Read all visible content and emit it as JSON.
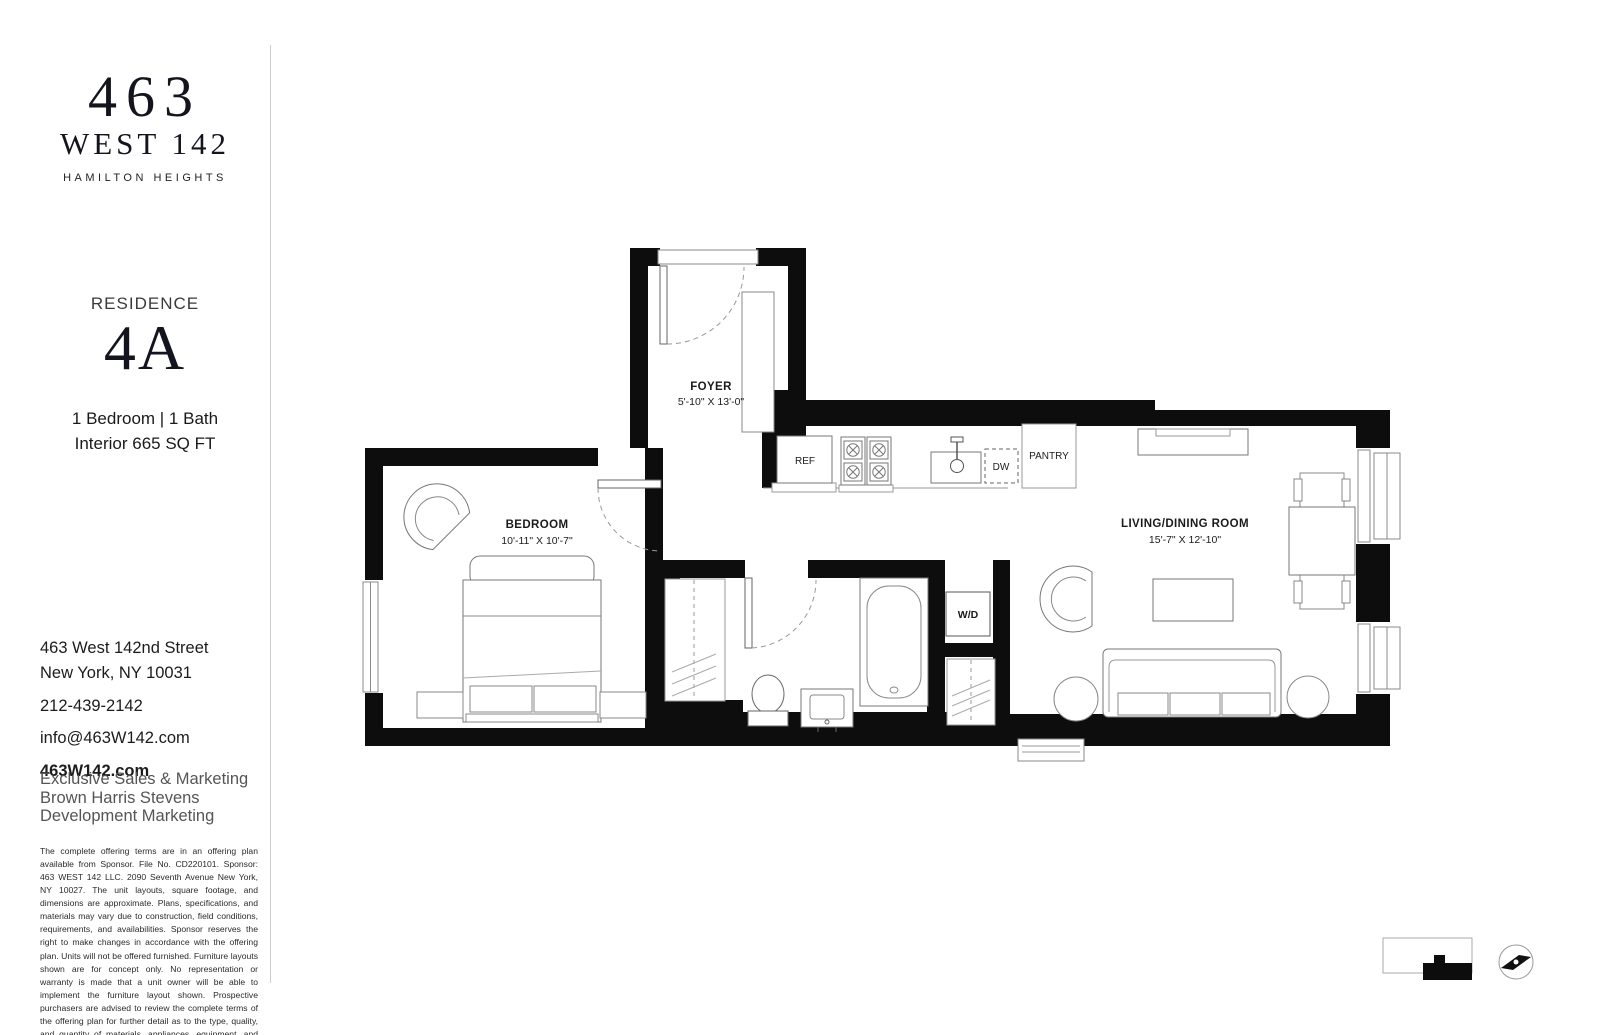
{
  "sidebar": {
    "logo": {
      "line1": "463",
      "line2": "WEST 142",
      "tagline": "HAMILTON HEIGHTS"
    },
    "residence": {
      "label": "RESIDENCE",
      "unit": "4A",
      "beds_baths": "1 Bedroom | 1 Bath",
      "interior": "Interior 665 SQ FT"
    },
    "contact": {
      "address_line1": "463 West 142nd Street",
      "address_line2": "New York, NY 10031",
      "phone": "212-439-2142",
      "email": "info@463W142.com",
      "website": "463W142.com"
    },
    "marketing": {
      "line1": "Exclusive Sales & Marketing",
      "line2": "Brown Harris Stevens",
      "line3": "Development Marketing"
    },
    "disclaimer": "The complete offering terms are in an offering plan available from Sponsor. File No. CD220101. Sponsor: 463 WEST 142 LLC. 2090 Seventh Avenue New York, NY 10027. The unit layouts, square footage, and dimensions are approximate. Plans, specifications, and materials may vary due to construction, field conditions, requirements, and availabilities. Sponsor reserves the right to make changes in accordance with the offering plan. Units will not be offered furnished. Furniture layouts shown are for concept only. No representation or warranty is made that a unit owner will be able to implement the furniture layout shown. Prospective purchasers are advised to review the complete terms of the offering plan for further detail as to the type, quality, and quantity of materials, appliances, equipment, and fixtures to be included in the units. Equal Housing Opportunity."
  },
  "floorplan": {
    "rooms": {
      "foyer": {
        "name": "FOYER",
        "dims": "5'-10\" X 13'-0\""
      },
      "bedroom": {
        "name": "BEDROOM",
        "dims": "10'-11\" X 10'-7\""
      },
      "living": {
        "name": "LIVING/DINING ROOM",
        "dims": "15'-7\" X 12'-10\""
      }
    },
    "fixtures": {
      "ref": "REF",
      "dw": "DW",
      "pantry": "PANTRY",
      "wd": "W/D"
    },
    "colors": {
      "wall": "#0d0d0d",
      "line": "#888888"
    }
  }
}
